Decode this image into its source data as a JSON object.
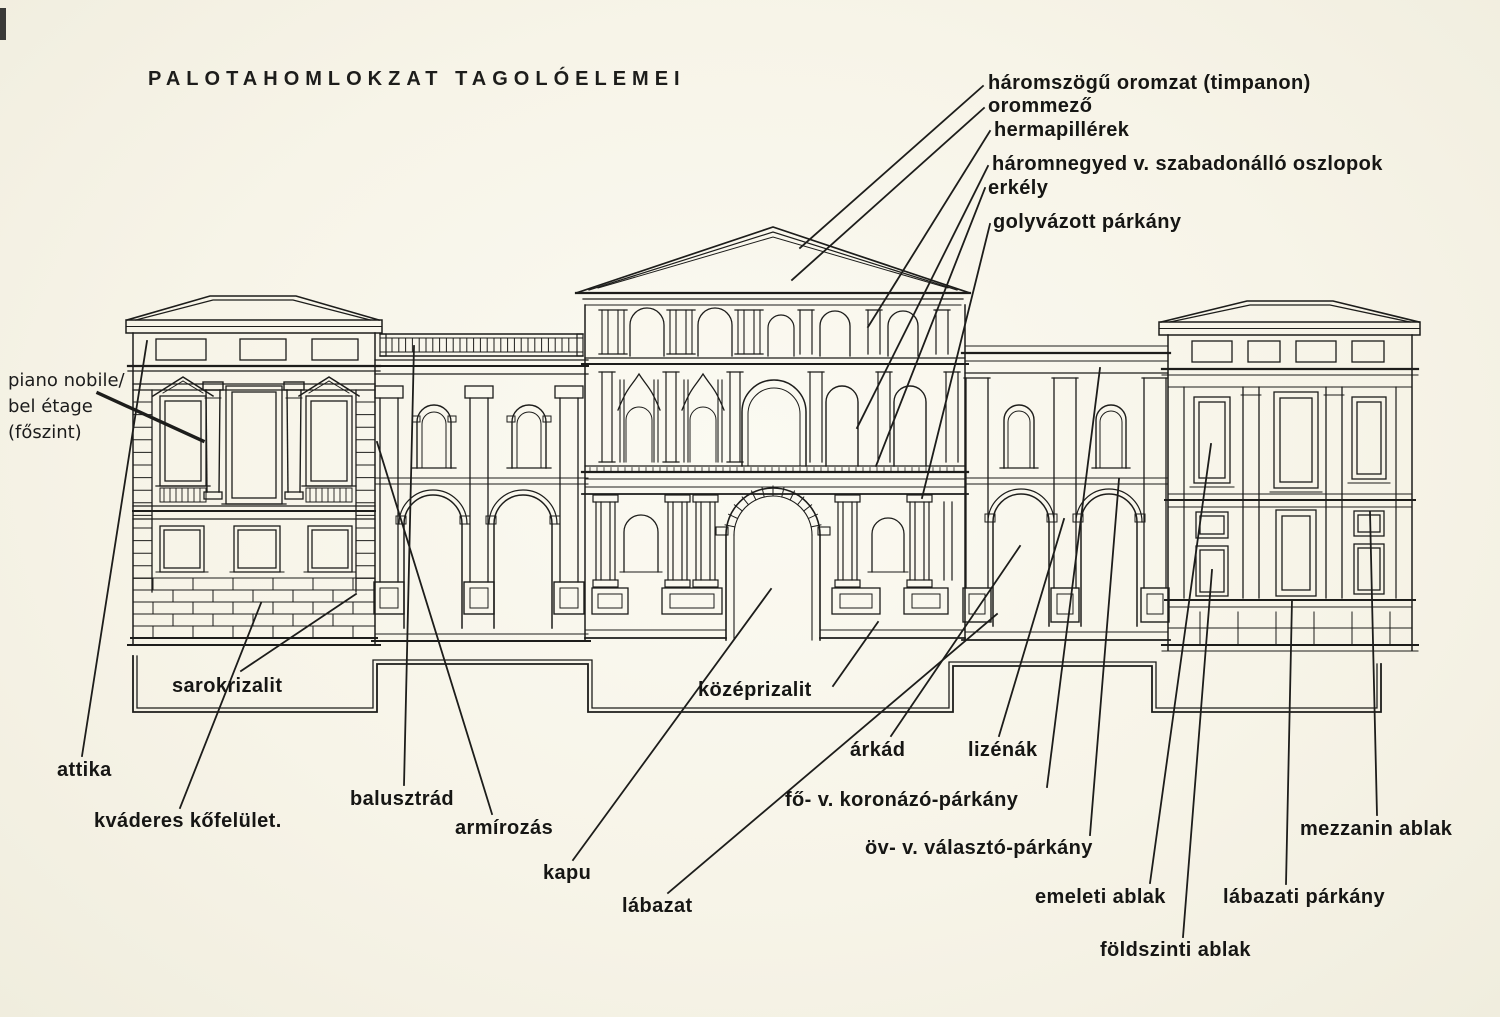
{
  "title": "PALOTAHOMLOKZAT TAGOLÓELEMEI",
  "colors": {
    "paper": "#f6f3e7",
    "ink": "#1d1d1b"
  },
  "labels": {
    "timpanon": "háromszögű oromzat (timpanon)",
    "orommezo": "orommező",
    "hermapillerek": "hermapillérek",
    "oszlopok": "háromnegyed v. szabadonálló oszlopok",
    "erkely": "erkély",
    "golyvazott_parkany": "golyvázott párkány",
    "piano_nobile_line1": "piano nobile/",
    "piano_nobile_line2": "bel étage",
    "piano_nobile_line3": "(főszint)",
    "attika": "attika",
    "kvaderes": "kváderes kőfelület.",
    "sarokrizalit": "sarokrizalit",
    "balusztrad": "balusztrád",
    "armirozas": "armírozás",
    "kapu": "kapu",
    "labazat": "lábazat",
    "kozeprizalit": "középrizalit",
    "arkad": "árkád",
    "lizenak": "lizénák",
    "fo_parkany": "fő- v. koronázó-párkány",
    "ov_parkany": "öv- v. választó-párkány",
    "emeleti_ablak": "emeleti ablak",
    "foldszinti_ablak": "földszinti ablak",
    "labazati_parkany": "lábazati párkány",
    "mezzanin_ablak": "mezzanin ablak"
  }
}
